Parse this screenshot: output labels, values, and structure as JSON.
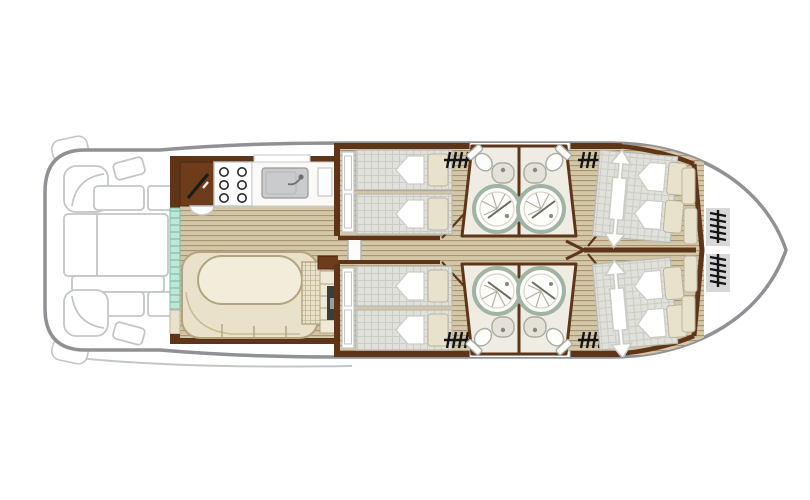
{
  "plan": {
    "title": "Canal boat deck plan",
    "vessel_orientation": "bow-right",
    "areas": {
      "stern_deck": {
        "name": "Aft open deck",
        "furniture": [
          "corner seat port",
          "corner seat starboard",
          "aft bench port",
          "aft bench starboard",
          "deck table group",
          "step box port",
          "step box starboard",
          "mooring fenders"
        ]
      },
      "saloon": {
        "name": "Saloon / galley",
        "furniture": [
          "helm console with tiller lever",
          "helm seat",
          "gas hob 6-burner",
          "sink with faucet",
          "worktop with window",
          "sliding patio door",
          "U-shaped dinette bench",
          "oval table",
          "upholstered bench",
          "shelf",
          "fridge cabinet"
        ]
      },
      "mid_cabins": {
        "name": "Midship twin cabins (port & starboard)",
        "furniture": [
          "twin single beds with pillows and duvets",
          "wardrobe",
          "deck access steps",
          "cabin door"
        ]
      },
      "bathrooms": {
        "name": "Four ensuite shower rooms",
        "fixtures_each": [
          "round shower cubicle",
          "washbasin",
          "marine toilet"
        ]
      },
      "bow_cabins": {
        "name": "Bow double cabins (port & starboard)",
        "furniture": [
          "sliding double bed with adjustment arrow",
          "pillows",
          "duvets",
          "deck access steps",
          "cabin door"
        ]
      },
      "bow_deck": {
        "name": "Bow deck",
        "furniture": [
          "cushion lockers",
          "boarding steps port",
          "boarding steps starboard"
        ]
      }
    },
    "icons": [
      "steps-icon",
      "shower-icon",
      "toilet-icon",
      "washbasin-icon",
      "faucet-icon",
      "burner-icon",
      "slide-arrow-icon",
      "helm-lever-icon"
    ]
  },
  "colors": {
    "hull": "#8f9194",
    "furn": "#c3c6c8",
    "wall": "#5e3519",
    "wall_dark": "#4a2a12",
    "teak_light": "#d3c7a8",
    "teak_dark": "#a59470",
    "mattress": "#e1e1dc",
    "mattress_grid": "#ccccc6",
    "bath_floor": "#efece3",
    "shower_ring": "#9fb4a2",
    "mint": "#bfe7d8",
    "mint_stripe": "#83c6b0",
    "bench": "#e9e1c9",
    "bench_line": "#b1a47e",
    "table": "#f2edda",
    "blanket": "#e8e1cc",
    "blanket_line": "#bdb49c",
    "cabinet": "#6e3b1b",
    "appliance": "#3c3c3c",
    "locker": "#d8d8d8",
    "steps": "#151515",
    "sink_gray": "#c9cbcd"
  }
}
